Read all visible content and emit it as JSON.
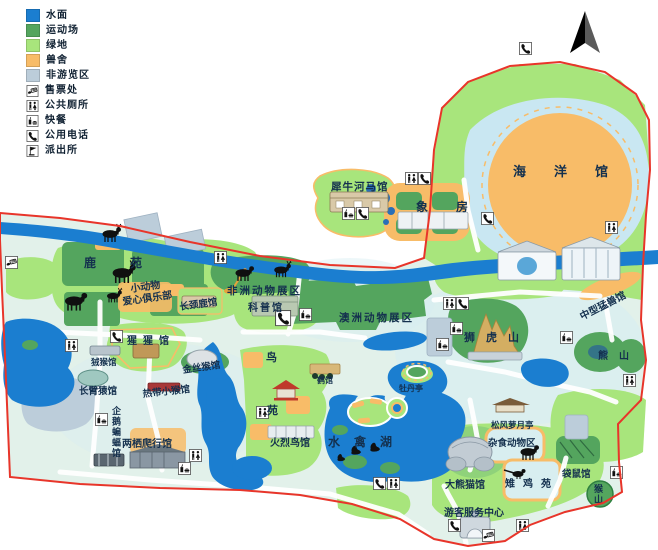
{
  "legend": {
    "items": [
      {
        "kind": "swatch",
        "label": "水面",
        "color": "#1b7ed0"
      },
      {
        "kind": "swatch",
        "label": "运动场",
        "color": "#54a55e"
      },
      {
        "kind": "swatch",
        "label": "绿地",
        "color": "#a8e57c"
      },
      {
        "kind": "swatch",
        "label": "兽舍",
        "color": "#f8bc68"
      },
      {
        "kind": "swatch",
        "label": "非游览区",
        "color": "#bccdda"
      },
      {
        "kind": "icon",
        "icon": "ticket",
        "label": "售票处"
      },
      {
        "kind": "icon",
        "icon": "toilet",
        "label": "公共厕所"
      },
      {
        "kind": "icon",
        "icon": "fastfood",
        "label": "快餐"
      },
      {
        "kind": "icon",
        "icon": "phone",
        "label": "公用电话"
      },
      {
        "kind": "icon",
        "icon": "police",
        "label": "派出所"
      }
    ]
  },
  "compass": {
    "name": "north-arrow"
  },
  "map": {
    "colors": {
      "water": "#1b7ed0",
      "sport_green": "#54a55e",
      "lawn_green": "#a8e57c",
      "animal_house": "#f8bc68",
      "non_tour": "#bccdda",
      "boundary": "#e8352a",
      "ground": "#e2f1ea",
      "pale_water": "#c9e7f2",
      "road": "#ffffff",
      "label": "#14304e"
    },
    "labels": [
      {
        "id": "ocean-hall",
        "text": "海洋馆",
        "x": 513,
        "y": 176,
        "size": 13,
        "ls": 28
      },
      {
        "id": "rhino-hippo-hall",
        "text": "犀牛河马馆",
        "x": 331,
        "y": 190,
        "size": 10.5,
        "ls": 1
      },
      {
        "id": "elephant-house",
        "text": "象房",
        "x": 416,
        "y": 211,
        "size": 12,
        "ls": 28
      },
      {
        "id": "deer-garden",
        "text": "鹿苑",
        "x": 84,
        "y": 267,
        "size": 12,
        "ls": 34
      },
      {
        "id": "small-animal-club-line1",
        "text": "小动物",
        "x": 131,
        "y": 292,
        "size": 10,
        "rotate": -8
      },
      {
        "id": "small-animal-club-line2",
        "text": "爱心俱乐部",
        "x": 123,
        "y": 305,
        "size": 10,
        "rotate": -8
      },
      {
        "id": "giraffe-hall",
        "text": "长颈鹿馆",
        "x": 180,
        "y": 310,
        "size": 9.5,
        "rotate": -8
      },
      {
        "id": "africa-animal-zone",
        "text": "非洲动物展区",
        "x": 227,
        "y": 294,
        "size": 10.5,
        "ls": 2
      },
      {
        "id": "science-hall",
        "text": "科普馆",
        "x": 248,
        "y": 311,
        "size": 10,
        "ls": 2
      },
      {
        "id": "australia-animal-zone",
        "text": "澳洲动物展区",
        "x": 339,
        "y": 321,
        "size": 10.5,
        "ls": 2
      },
      {
        "id": "lion-tiger-hill",
        "text": "狮虎山",
        "x": 464,
        "y": 341,
        "size": 11,
        "ls": 11
      },
      {
        "id": "medium-beast-hall",
        "text": "中型猛兽馆",
        "x": 582,
        "y": 320,
        "size": 10,
        "rotate": -27
      },
      {
        "id": "bear-hill",
        "text": "熊山",
        "x": 598,
        "y": 359,
        "size": 10,
        "ls": 11
      },
      {
        "id": "orangutan-hall",
        "text": "猩猩馆",
        "x": 127,
        "y": 344,
        "size": 10,
        "ls": 6
      },
      {
        "id": "marmoset-hall",
        "text": "狨猴馆",
        "x": 91,
        "y": 365,
        "size": 8.5
      },
      {
        "id": "gibbon-hall",
        "text": "长臂猿馆",
        "x": 79,
        "y": 394,
        "size": 9.5
      },
      {
        "id": "golden-monkey-hall",
        "text": "金丝猴馆",
        "x": 183,
        "y": 373,
        "size": 9.5,
        "rotate": -8
      },
      {
        "id": "tropical-monkey-hall",
        "text": "热带小猴馆",
        "x": 143,
        "y": 397,
        "size": 9.5,
        "rotate": -6
      },
      {
        "id": "bird-garden-char1",
        "text": "鸟",
        "x": 266,
        "y": 361,
        "size": 11
      },
      {
        "id": "bird-garden-char2",
        "text": "苑",
        "x": 267,
        "y": 414,
        "size": 11
      },
      {
        "id": "crane-hall",
        "text": "鹤馆",
        "x": 317,
        "y": 383,
        "size": 8
      },
      {
        "id": "peony-pavilion",
        "text": "牡丹亭",
        "x": 399,
        "y": 391,
        "size": 8
      },
      {
        "id": "waterfowl-lake",
        "text": "水禽湖",
        "x": 328,
        "y": 446,
        "size": 12,
        "ls": 14
      },
      {
        "id": "penguin-bat-hall",
        "text": "企鹅蝙蝠馆",
        "x": 112,
        "y": 414,
        "size": 9,
        "vertical": true
      },
      {
        "id": "amphibian-reptile-hall",
        "text": "两栖爬行馆",
        "x": 122,
        "y": 447,
        "size": 10
      },
      {
        "id": "flamingo-hall",
        "text": "火烈鸟馆",
        "x": 270,
        "y": 446,
        "size": 10
      },
      {
        "id": "songfeng-luoyue-pavilion",
        "text": "松风萝月亭",
        "x": 491,
        "y": 428,
        "size": 8.5
      },
      {
        "id": "omnivore-zone",
        "text": "杂食动物区",
        "x": 488,
        "y": 446,
        "size": 9.5
      },
      {
        "id": "giant-panda-hall",
        "text": "大熊猫馆",
        "x": 445,
        "y": 488,
        "size": 10
      },
      {
        "id": "pheasant-garden",
        "text": "雉鸡苑",
        "x": 505,
        "y": 487,
        "size": 10,
        "ls": 8
      },
      {
        "id": "kangaroo-hall",
        "text": "袋鼠馆",
        "x": 562,
        "y": 477,
        "size": 9.5
      },
      {
        "id": "monkey-hill",
        "text": "猴山",
        "x": 594,
        "y": 492,
        "size": 9,
        "vertical": true
      },
      {
        "id": "visitor-service-center",
        "text": "游客服务中心",
        "x": 444,
        "y": 516,
        "size": 10
      }
    ],
    "icons": [
      {
        "type": "phone",
        "x": 519,
        "y": 42
      },
      {
        "type": "toilet",
        "x": 405,
        "y": 172
      },
      {
        "type": "phone",
        "x": 418,
        "y": 172
      },
      {
        "type": "fastfood",
        "x": 342,
        "y": 207
      },
      {
        "type": "phone",
        "x": 356,
        "y": 207
      },
      {
        "type": "toilet",
        "x": 214,
        "y": 251
      },
      {
        "type": "phone",
        "x": 481,
        "y": 212
      },
      {
        "type": "toilet",
        "x": 605,
        "y": 221
      },
      {
        "type": "fastfood",
        "x": 299,
        "y": 308
      },
      {
        "type": "phone",
        "x": 275,
        "y": 310,
        "s": 1.25
      },
      {
        "type": "toilet",
        "x": 443,
        "y": 297
      },
      {
        "type": "phone",
        "x": 456,
        "y": 297
      },
      {
        "type": "fastfood",
        "x": 450,
        "y": 322
      },
      {
        "type": "fastfood",
        "x": 436,
        "y": 338
      },
      {
        "type": "fastfood",
        "x": 560,
        "y": 331
      },
      {
        "type": "toilet",
        "x": 623,
        "y": 374
      },
      {
        "type": "toilet",
        "x": 65,
        "y": 339
      },
      {
        "type": "phone",
        "x": 110,
        "y": 330
      },
      {
        "type": "toilet",
        "x": 256,
        "y": 406
      },
      {
        "type": "fastfood",
        "x": 95,
        "y": 413
      },
      {
        "type": "toilet",
        "x": 189,
        "y": 449
      },
      {
        "type": "fastfood",
        "x": 178,
        "y": 462
      },
      {
        "type": "phone",
        "x": 373,
        "y": 477
      },
      {
        "type": "toilet",
        "x": 387,
        "y": 477
      },
      {
        "type": "fastfood",
        "x": 610,
        "y": 466
      },
      {
        "type": "toilet",
        "x": 516,
        "y": 519
      },
      {
        "type": "phone",
        "x": 448,
        "y": 519
      },
      {
        "type": "ticket",
        "x": 482,
        "y": 529
      },
      {
        "type": "ticket",
        "x": 5,
        "y": 256
      }
    ],
    "animals": [
      {
        "type": "deer",
        "x": 110,
        "y": 234,
        "s": 1.0
      },
      {
        "type": "deer",
        "x": 122,
        "y": 273,
        "s": 1.25
      },
      {
        "type": "quad",
        "x": 74,
        "y": 301,
        "s": 1.2
      },
      {
        "type": "deer",
        "x": 113,
        "y": 296,
        "s": 0.8
      },
      {
        "type": "quad",
        "x": 243,
        "y": 273,
        "s": 1.0
      },
      {
        "type": "deer",
        "x": 281,
        "y": 270,
        "s": 0.9
      },
      {
        "type": "swan",
        "x": 352,
        "y": 452,
        "s": 1
      },
      {
        "type": "swan",
        "x": 371,
        "y": 449,
        "s": 1
      },
      {
        "type": "swan",
        "x": 338,
        "y": 459,
        "s": 0.8
      },
      {
        "type": "quad",
        "x": 528,
        "y": 452,
        "s": 1.0
      },
      {
        "type": "pheasant",
        "x": 518,
        "y": 474,
        "s": 1
      }
    ]
  }
}
